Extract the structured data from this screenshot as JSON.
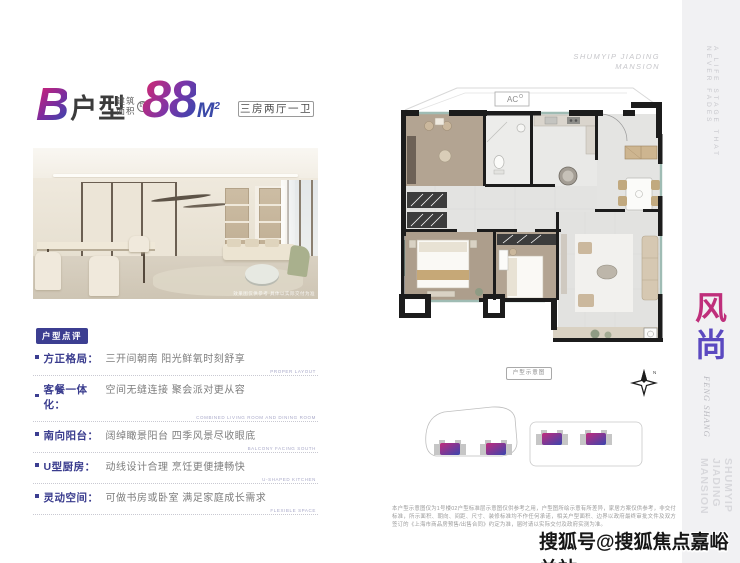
{
  "header": {
    "unit_letter": "B",
    "unit_suffix": "户型",
    "area_label_line1": "建筑",
    "area_label_line2": "面积",
    "area_circle": "约",
    "area_value": "88",
    "area_unit": "M",
    "area_sup": "2",
    "spec": "三房两厅一卫"
  },
  "photo": {
    "caption": "效果图仅供参考 具体以实际交付为准"
  },
  "review": {
    "badge": "户型点评",
    "items": [
      {
        "label": "方正格局：",
        "text": "三开间朝南 阳光鲜氧时刻舒享",
        "en": "PROPER LAYOUT"
      },
      {
        "label": "客餐一体化：",
        "text": "空间无缝连接 聚会派对更从容",
        "en": "COMBINED LIVING ROOM AND DINING ROOM"
      },
      {
        "label": "南向阳台：",
        "text": "阔绰瞰景阳台 四季风景尽收眼底",
        "en": "BALCONY FACING SOUTH"
      },
      {
        "label": "U型厨房：",
        "text": "动线设计合理 烹饪更便捷畅快",
        "en": "U-SHAPED KITCHEN"
      },
      {
        "label": "灵动空间：",
        "text": "可做书房或卧室 满足家庭成长需求",
        "en": "FLEXIBLE SPACE"
      }
    ]
  },
  "plan": {
    "ac_label": "AC",
    "diagram_label": "户型示意图",
    "compass_n": "N"
  },
  "branding": {
    "top_right_line1": "SHUMYIP JIADING",
    "top_right_line2": "MANSION",
    "strip_tagline": "A LIFE STAGE THAT NEVER FADES",
    "strip_cn_char1": "风",
    "strip_cn_char2": "尚",
    "strip_en": "FENG SHANG",
    "strip_bottom_line1": "SHUMYIP JIADING",
    "strip_bottom_line2": "MANSION"
  },
  "disclaimer": "本户型示意图仅为1号楼02户型标准层示意图仅供参考之用，户型图所绘示意有所差异，家居方案仅供参考，非交付标准，所示面积、朝向、间距、尺寸、装修标准均不作任何承诺，相关户型面积、边界以政府最终审批文件及双方签订的《上海市商品房预售/出售合同》约定为准，届时请以实际交付及政府实测为准。",
  "watermark": "搜狐号@搜狐焦点嘉峪关站",
  "colors": {
    "brand_magenta": "#c12a7c",
    "brand_indigo": "#3a46ae",
    "review_accent": "#3c3e91",
    "strip_bg": "#f1f1f3",
    "wall_black": "#1c1c1c",
    "wood_floor": "#b3a492",
    "tile_floor": "#e4e4e2"
  }
}
